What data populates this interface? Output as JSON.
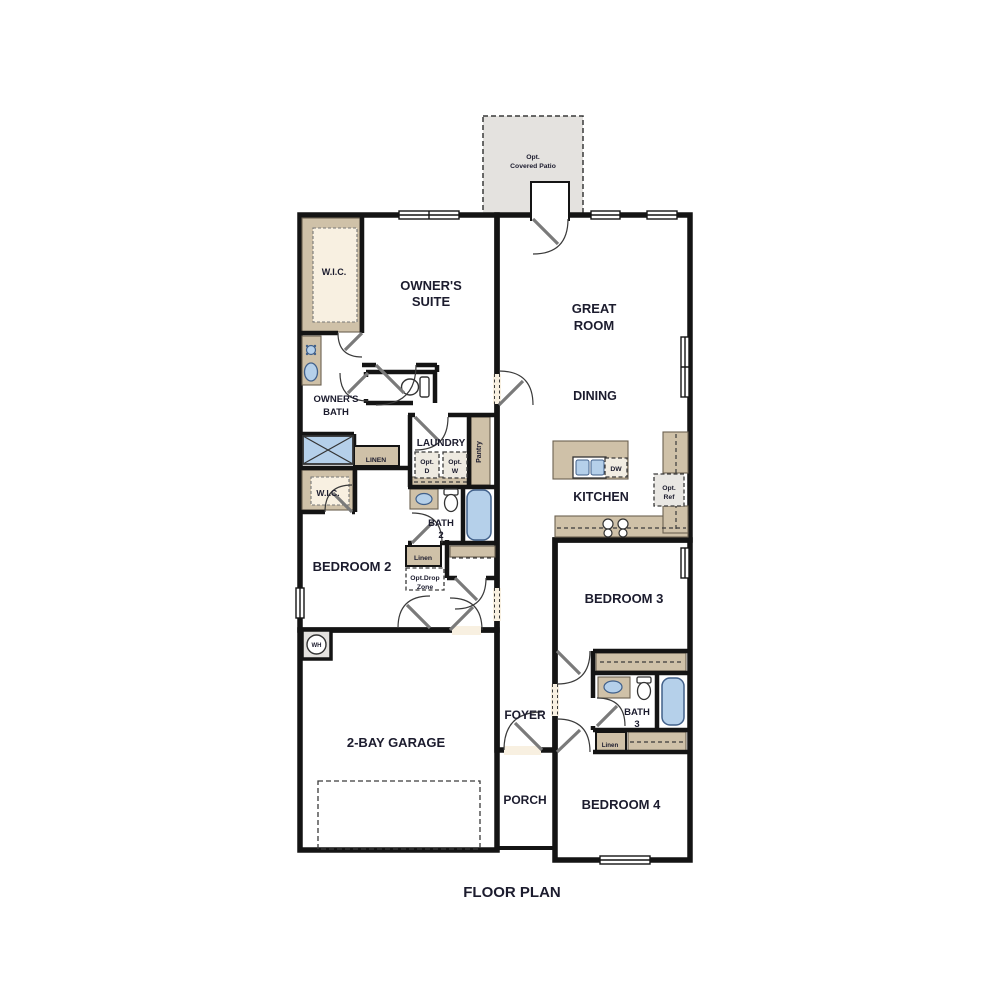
{
  "title": {
    "floor_plan": "FLOOR PLAN"
  },
  "colors": {
    "room_fill": "#f8f0e1",
    "utility_fill": "#e4e2df",
    "cabinet_tan": "#cfc1a8",
    "fixture_blue": "#b5d0ea",
    "wall_black": "#141414",
    "text_dark": "#1c1c2e"
  },
  "rooms": {
    "patio": {
      "line1": "Opt.",
      "line2": "Covered Patio"
    },
    "wic_owner": {
      "label": "W.I.C."
    },
    "owners_suite": {
      "line1": "OWNER'S",
      "line2": "SUITE"
    },
    "great_room": {
      "line1": "GREAT",
      "line2": "ROOM"
    },
    "owners_bath": {
      "line1": "OWNER'S",
      "line2": "BATH"
    },
    "dining": {
      "label": "DINING"
    },
    "laundry": {
      "label": "LAUNDRY",
      "opt_d_line1": "Opt.",
      "opt_d_line2": "D",
      "opt_w_line1": "Opt.",
      "opt_w_line2": "W"
    },
    "pantry": {
      "label": "Pantry"
    },
    "linen_owner": {
      "label": "LINEN"
    },
    "kitchen": {
      "label": "KITCHEN",
      "dw": "DW",
      "opt_ref_line1": "Opt.",
      "opt_ref_line2": "Ref"
    },
    "wic_bed2": {
      "label": "W.I.C."
    },
    "bath2": {
      "line1": "BATH",
      "line2": "2"
    },
    "bedroom2": {
      "label": "BEDROOM 2"
    },
    "linen_hall": {
      "label": "Linen"
    },
    "drop_zone": {
      "line1": "Opt.Drop",
      "line2": "Zone"
    },
    "garage": {
      "label": "2-BAY GARAGE",
      "wh": "WH"
    },
    "foyer": {
      "label": "FOYER"
    },
    "porch": {
      "label": "PORCH"
    },
    "bedroom3": {
      "label": "BEDROOM 3"
    },
    "bath3": {
      "line1": "BATH",
      "line2": "3"
    },
    "linen_bed4": {
      "label": "Linen"
    },
    "bedroom4": {
      "label": "BEDROOM 4"
    }
  }
}
